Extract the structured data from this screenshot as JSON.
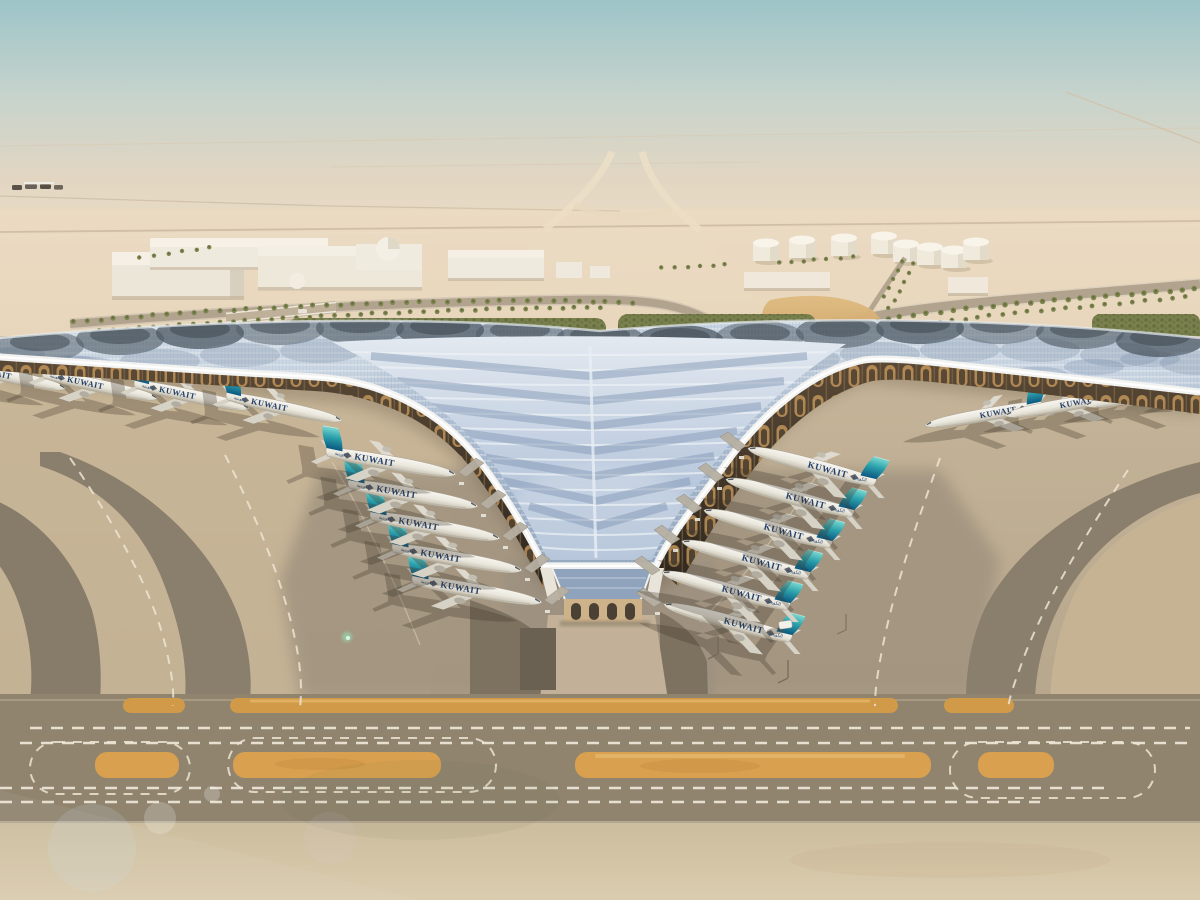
{
  "image": {
    "kind": "aerial architectural rendering",
    "subject": "Kuwait International Airport new terminal concept in the desert",
    "camera": "high oblique aerial view",
    "sky": {
      "top": "#9dc4c8",
      "middle": "#c8d4cc",
      "horizon_haze": "#e7d8c2"
    }
  },
  "aircraft": {
    "airline_title": "KUWAIT",
    "airline_title_arabic": "الكويتية",
    "fleet_visible": 19,
    "gate_rows": {
      "left_v_row": 5,
      "right_v_row": 6,
      "left_wing_row": 4,
      "right_wing_row": 4
    },
    "livery": {
      "fuselage": "#efece4",
      "tail_teal_top": "#79d8d0",
      "tail_teal_bottom": "#0b567f",
      "title_color": "#24406a"
    }
  },
  "terminal": {
    "roof_style": "swooping trefoil lattice roof with photovoltaic panels and central V funnel",
    "roof_white": "#f2f3f1",
    "roof_panel_light": "#c9d5e2",
    "roof_panel_mid": "#9fb3ca",
    "roof_panel_dark": "#4e5a64",
    "soffit_gold": "#c8995c",
    "entrance_pavilion": "glazed apex pavilion with flared columns"
  },
  "ground": {
    "apron_gray": "#a89b85",
    "taxiway_dark": "#887c6a",
    "desert_sand": "#e0cdaf",
    "foreground_sand": "#d5c6a8",
    "runway_strip_orange": "#d09a48",
    "marking_white": "#efe8d8",
    "greenery": "#5f6d36"
  },
  "background": {
    "features": [
      "distant perimeter roads",
      "white warehouse buildings",
      "domed building",
      "fuel tank farm",
      "palm-lined approach roads",
      "highway interchange",
      "landscaped hedges",
      "service vehicles and light poles on apron"
    ],
    "tank_count": 8,
    "vehicle_count_foreground": 1
  }
}
